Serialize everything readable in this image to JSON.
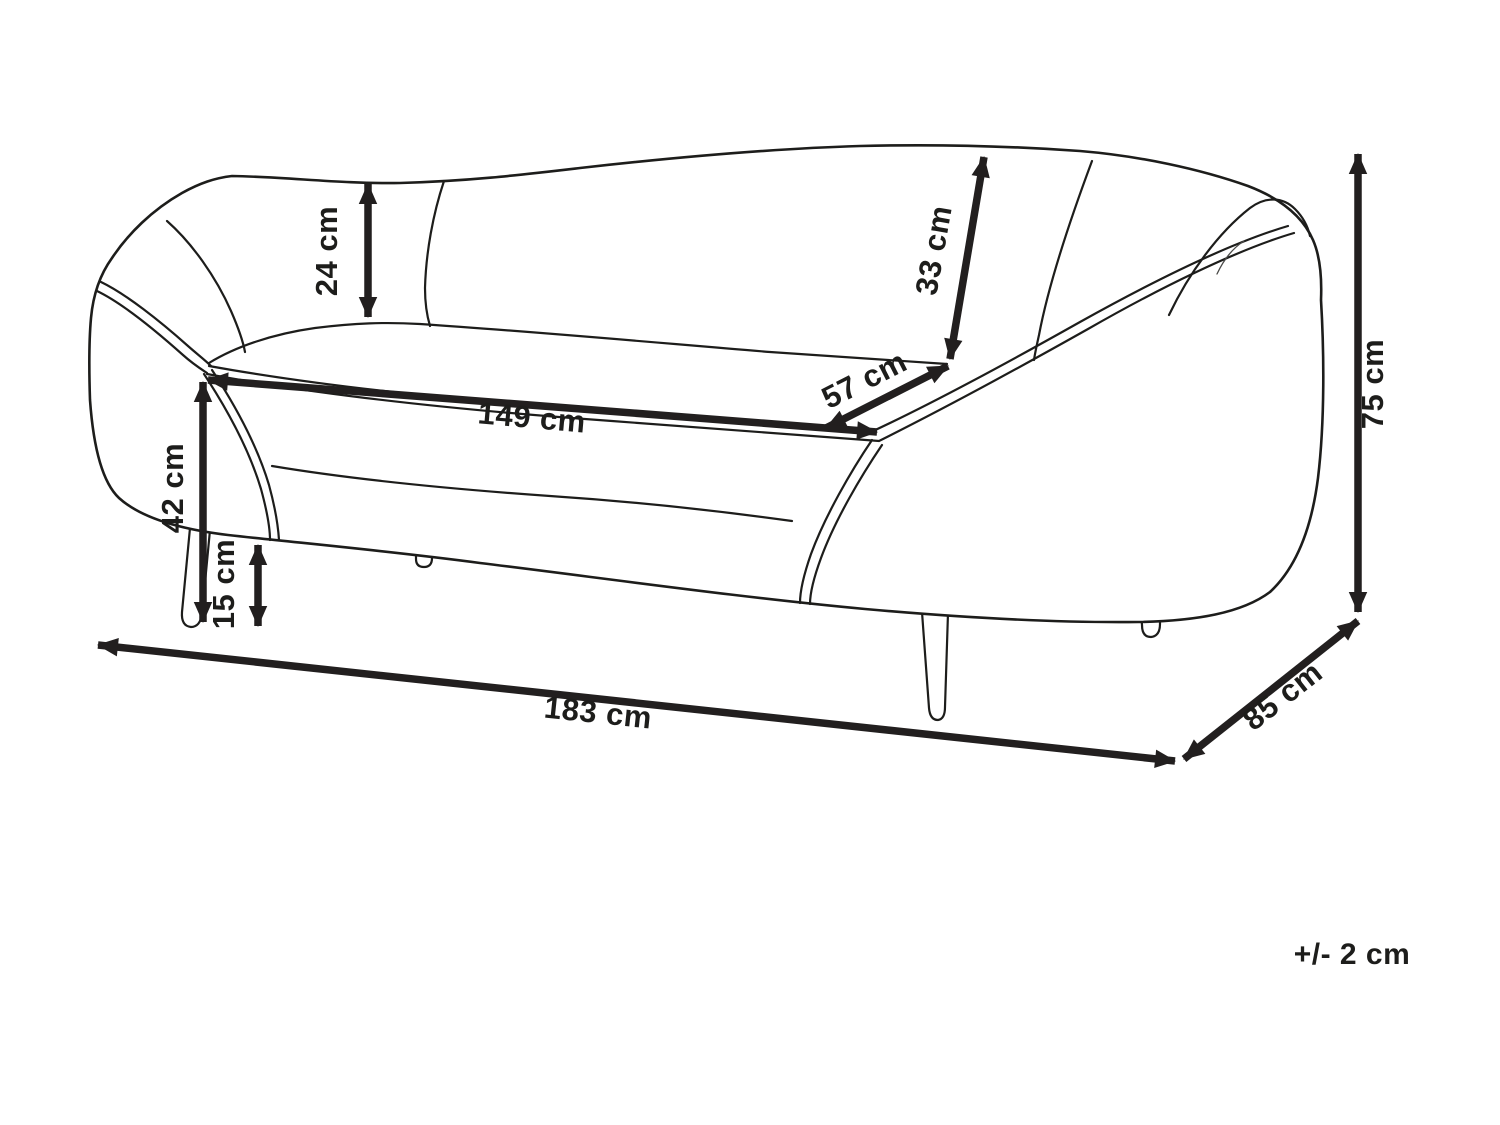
{
  "title": "Sofa dimension diagram",
  "colors": {
    "background": "#ffffff",
    "line": "#1d1d1b",
    "dimension_arrow": "#221f1f"
  },
  "diagram": {
    "subject": "curved three-seater sofa line drawing",
    "units": "cm",
    "tolerance_note": "+/- 2 cm",
    "dimensions": [
      {
        "name": "backrest-height",
        "label": "24 cm",
        "value": 24
      },
      {
        "name": "backrest-slant-height",
        "label": "33 cm",
        "value": 33
      },
      {
        "name": "seat-depth",
        "label": "57 cm",
        "value": 57
      },
      {
        "name": "seat-width",
        "label": "149 cm",
        "value": 149
      },
      {
        "name": "seat-height",
        "label": "42 cm",
        "value": 42
      },
      {
        "name": "leg-height",
        "label": "15 cm",
        "value": 15
      },
      {
        "name": "overall-width",
        "label": "183 cm",
        "value": 183
      },
      {
        "name": "overall-depth",
        "label": "85 cm",
        "value": 85
      },
      {
        "name": "overall-height",
        "label": "75 cm",
        "value": 75
      }
    ]
  }
}
